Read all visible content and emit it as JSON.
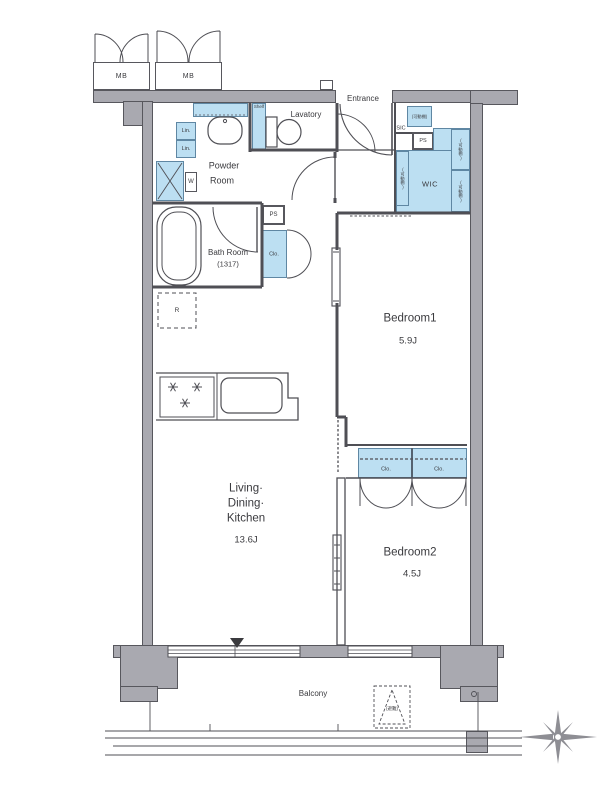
{
  "title": "1LDK+2BR apartment floor plan",
  "rooms": {
    "entrance": "Entrance",
    "lavatory": "Lavatory",
    "powder_line1": "Powder",
    "powder_line2": "Room",
    "bath_line1": "Bath Room",
    "bath_line2": "(1317)",
    "wic": "WIC",
    "sic": "SIC",
    "bedroom1": "Bedroom1",
    "bedroom1_size": "5.9J",
    "bedroom2": "Bedroom2",
    "bedroom2_size": "4.5J",
    "ldk_line1": "Living·",
    "ldk_line2": "Dining·",
    "ldk_line3": "Kitchen",
    "ldk_size": "13.6J",
    "balcony": "Balcony"
  },
  "fixtures": {
    "meter_box": "MB",
    "pipe_space": "PS",
    "washer": "W",
    "refrigerator": "R",
    "linen": "Lin.",
    "shelf": "Shelf",
    "closet": "Clo.",
    "movable_shelf": "(可動棚)",
    "evacuation_hatch": "(避難)"
  },
  "colors": {
    "wall_fill": "#a9a9b0",
    "wall_outline": "#57575d",
    "line": "#4f4f55",
    "closet_fill": "#bcdff2",
    "closet_border": "#5f87a3",
    "text": "#3a3a3e"
  }
}
